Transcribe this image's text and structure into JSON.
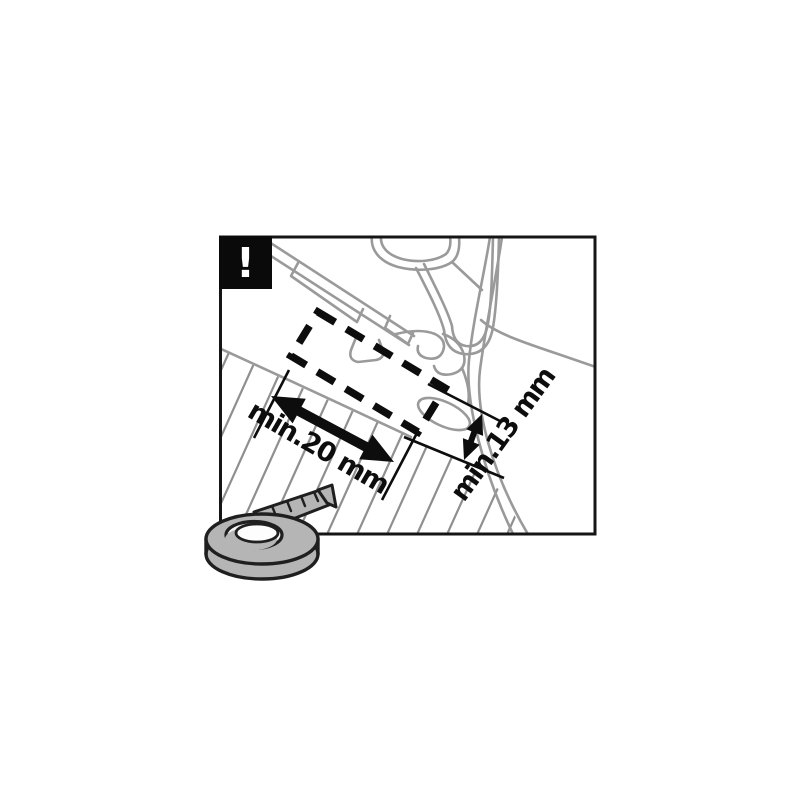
{
  "diagram": {
    "description": "Roof rack mounting instruction: minimum door-frame clearance measurements",
    "warning": {
      "symbol": "!"
    },
    "dimensions": {
      "width": {
        "label": "min.20 mm"
      },
      "height": {
        "label": "min.13 mm"
      }
    },
    "icons": {
      "warning_icon": "exclamation-mark",
      "tape_icon": "measuring-tape"
    },
    "colors": {
      "background": "#ffffff",
      "frame": "#151515",
      "ink": "#0d0d0d",
      "line_art": "#9a9a9a",
      "hatch": "#8f8f8f",
      "tape_fill": "#b5b5b5",
      "tape_hole": "#f4f4f4",
      "tape_outline": "#1f1f1f",
      "warning_bg": "#0a0a0a",
      "warning_fg": "#ffffff"
    }
  }
}
